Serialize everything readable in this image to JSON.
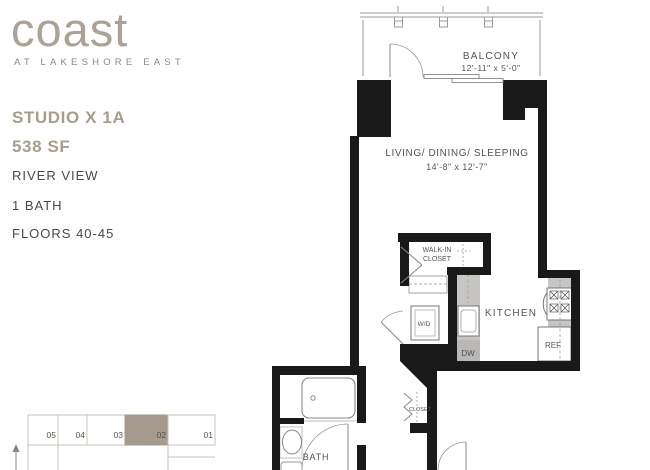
{
  "brand": {
    "logo": "coast",
    "tagline": "AT LAKESHORE EAST"
  },
  "unit": {
    "name": "STUDIO X 1A",
    "area": "538 SF",
    "view": "RIVER VIEW",
    "bath": "1 BATH",
    "floors": "FLOORS 40-45"
  },
  "plan": {
    "balcony": {
      "label": "BALCONY",
      "dims": "12'-11\" x 5'-0\""
    },
    "living": {
      "label": "LIVING/ DINING/ SLEEPING",
      "dims": "14'-8\" x 12'-7\""
    },
    "walkin_closet": {
      "line1": "WALK-IN",
      "line2": "CLOSET"
    },
    "washer_dryer": "W/D",
    "kitchen": "KITCHEN",
    "dishwasher": "DW",
    "refrigerator": "REF",
    "closet": "CLOSET",
    "bath": "BATH"
  },
  "keyplan": {
    "units": [
      "05",
      "04",
      "03",
      "02",
      "01"
    ],
    "highlighted_unit": "02"
  },
  "colors": {
    "accent_tan": "#a79d8b",
    "logo_tan": "#a9a295",
    "dark_text": "#4a4a44",
    "wall_black": "#191919",
    "line_gray": "#8b8b8b",
    "counter_gray": "#c6c5c3",
    "keyplan_highlight": "#a59a8e",
    "keyplan_border": "#c9c0b4",
    "keyplan_number": "#b9ac9d"
  }
}
